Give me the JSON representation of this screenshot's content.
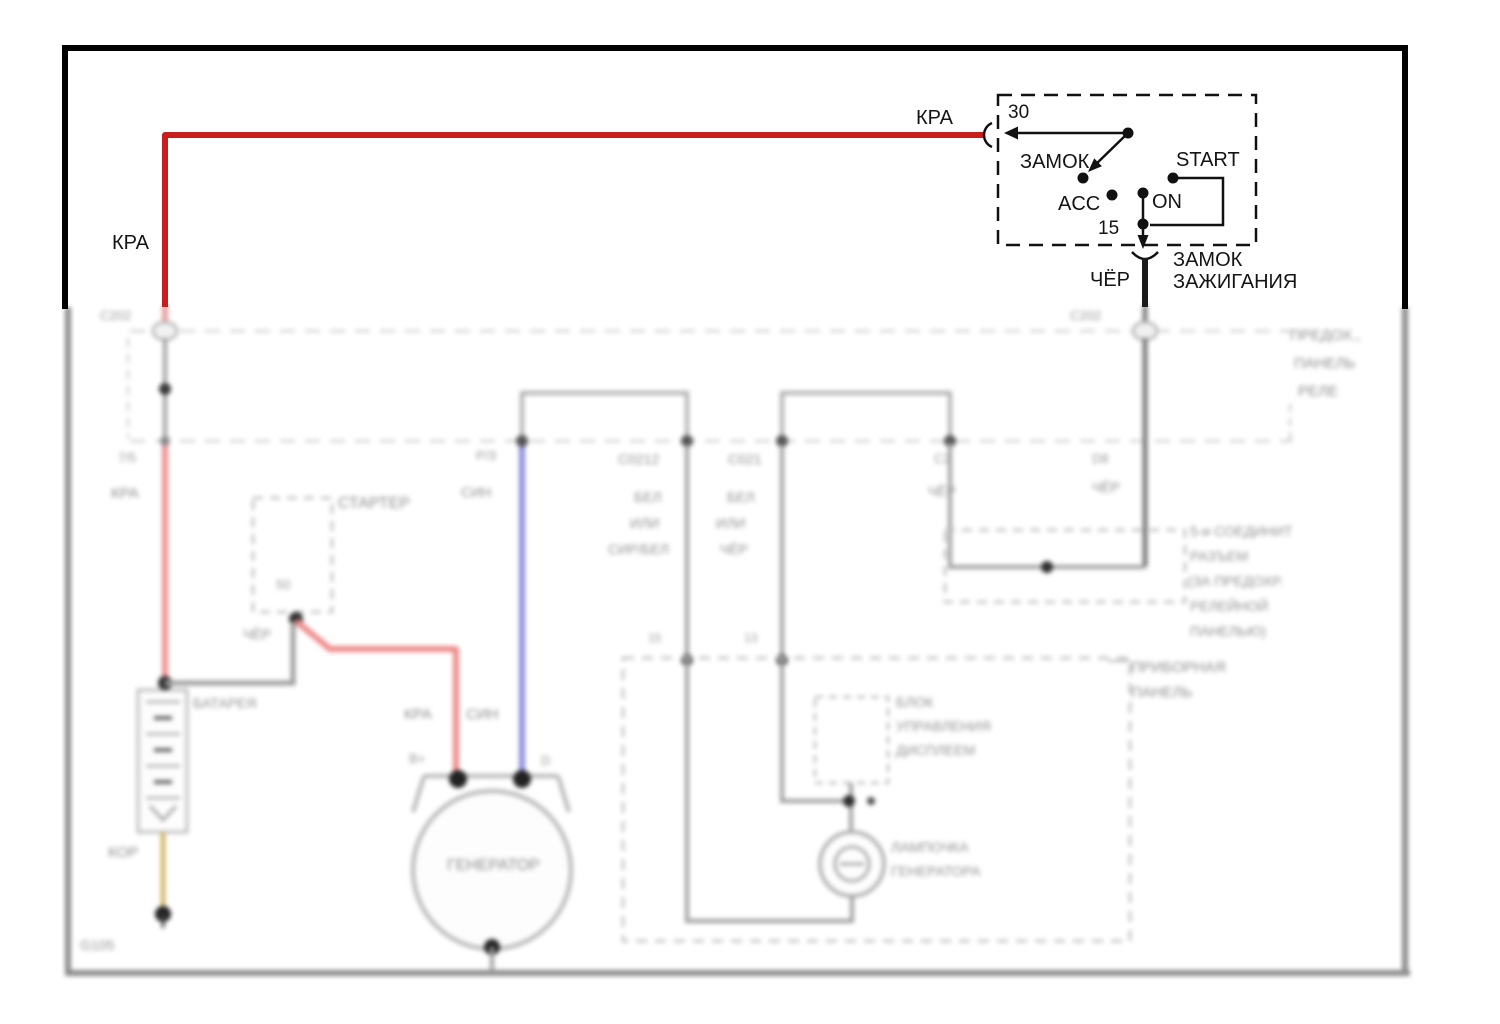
{
  "ignition_switch": {
    "terminal_30": "30",
    "lock_label": "ЗАМОК",
    "start_label": "START",
    "acc_label": "ACC",
    "on_label": "ON",
    "terminal_15": "15",
    "name_line1": "ЗАМОК",
    "name_line2": "ЗАЖИГАНИЯ"
  },
  "wires": {
    "kra_left": "КРА",
    "kra_right": "КРА",
    "cher_out": "ЧЁР"
  },
  "background": {
    "connector_left": "С202",
    "pin_left": "7/5",
    "wire_left": "КРА",
    "starter": "СТАРТЕР",
    "starter_pin": "50",
    "starter_wire": "ЧЁР",
    "battery": "БАТАРЕЯ",
    "battery_wire": "КОР",
    "ground_left": "G105",
    "gen_wire_red": "КРА",
    "gen_wire_blue": "СИН",
    "gen_term_b": "В+",
    "gen_term_d": "D",
    "generator": "ГЕНЕРАТОР",
    "blue_pin": "Р/З",
    "blue_color": "СИН",
    "col1": [
      "С0212",
      "БЕЛ",
      "ИЛИ",
      "СИР/БЕЛ"
    ],
    "col2": [
      "С021",
      "БЕЛ",
      "ИЛИ",
      "ЧЁР"
    ],
    "col3": [
      "С2",
      "ЧЁР"
    ],
    "ign_pin": "D8",
    "ign_wire": "ЧЁР",
    "connector_right": "С202",
    "fuse_panel": [
      "ПРЕДОХ.,",
      "ПАНЕЛЬ",
      "РЕЛЕ"
    ],
    "junction_note": [
      "5-и СОЕДИНИТ",
      "РАЗЪЕМ",
      "(ЗА ПРЕДОХР.",
      "РЕЛЕЙНОЙ",
      "ПАНЕЛЬЮ)"
    ],
    "instrument_panel": [
      "ПРИБОРНАЯ",
      "ПАНЕЛЬ"
    ],
    "display_unit": [
      "БЛОК",
      "УПРАВЛЕНИЯ",
      "ДИСПЛЕЕМ"
    ],
    "gen_lamp": [
      "ЛАМПОЧКА",
      "ГЕНЕРАТОРА"
    ],
    "pin_15": "15",
    "pin_13": "13"
  },
  "colors": {
    "power_wire": "#c81e1e",
    "ground_wire": "#1a1a1a",
    "blue_wire": "#8b8bd8",
    "faded_red": "#ef9090",
    "yellow_wire": "#d2b96a",
    "border": "#000000"
  }
}
